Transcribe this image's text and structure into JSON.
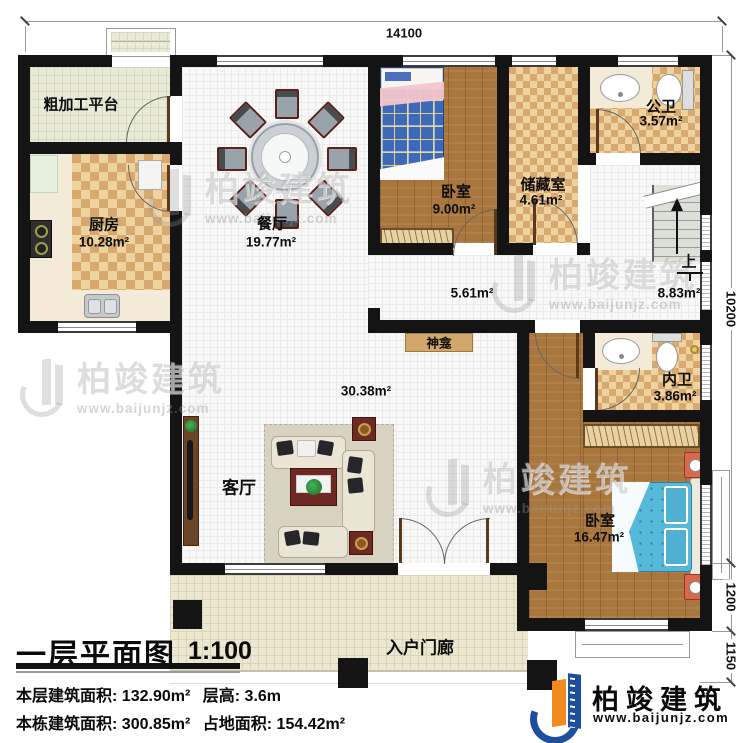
{
  "dimensions": {
    "top": "14100",
    "right_total": "10200",
    "right_lower": "1200",
    "right_bottom": "1150"
  },
  "rooms": {
    "rough_platform": {
      "name": "粗加工平台"
    },
    "kitchen": {
      "name": "厨房",
      "area": "10.28m²"
    },
    "dining": {
      "name": "餐厅",
      "area": "19.77m²"
    },
    "bedroom_top": {
      "name": "卧室",
      "area": "9.00m²"
    },
    "storage": {
      "name": "储藏室",
      "area": "4.61m²"
    },
    "public_bath": {
      "name": "公卫",
      "area": "3.57m²"
    },
    "hallway": {
      "area": "5.61m²"
    },
    "stair_hall": {
      "area": "8.83m²"
    },
    "stairs": {
      "direction_label": "上"
    },
    "inner_bath": {
      "name": "内卫",
      "area": "3.86m²"
    },
    "living": {
      "name": "客厅",
      "area": "30.38m²"
    },
    "shrine": {
      "name": "神龛"
    },
    "master_bedroom": {
      "name": "卧室",
      "area": "16.47m²"
    },
    "porch": {
      "name": "入户门廊"
    }
  },
  "title_block": {
    "title": "一层平面图",
    "scale": "1:100",
    "floor_area_label": "本层建筑面积:",
    "floor_area_value": "132.90m²",
    "floor_height_label": "层高:",
    "floor_height_value": "3.6m",
    "total_area_label": "本栋建筑面积:",
    "total_area_value": "300.85m²",
    "footprint_label": "占地面积:",
    "footprint_value": "154.42m²"
  },
  "brand": {
    "name": "柏竣建筑",
    "website": "www.baijunjz.com"
  },
  "colors": {
    "wall": "#141414",
    "logo_blue": "#1d4f9e",
    "logo_orange": "#f18a1f",
    "bed_blue": "#56b9da",
    "checker_light": "#eed3a0",
    "checker_dark": "#d8a96e"
  }
}
